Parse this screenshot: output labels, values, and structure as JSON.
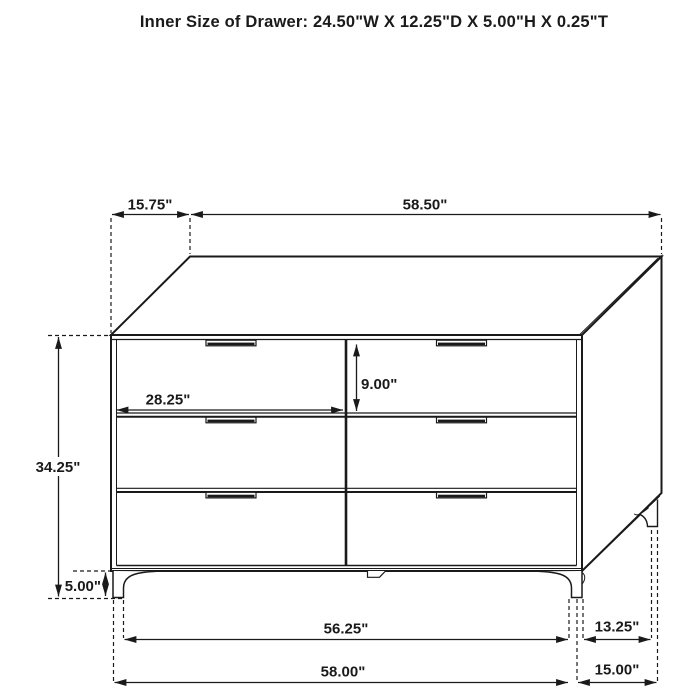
{
  "title": "Inner Size of Drawer: 24.50\"W X 12.25\"D X 5.00\"H X 0.25\"T",
  "dimensions": {
    "top_depth": "15.75\"",
    "top_width": "58.50\"",
    "drawer_opening_width": "28.25\"",
    "drawer_opening_height": "9.00\"",
    "body_height": "34.25\"",
    "leg_height": "5.00\"",
    "base_width": "56.25\"",
    "base_depth": "13.25\"",
    "overall_width": "58.00\"",
    "overall_depth": "15.00\""
  },
  "colors": {
    "line": "#1a1a1a",
    "background": "#ffffff"
  }
}
